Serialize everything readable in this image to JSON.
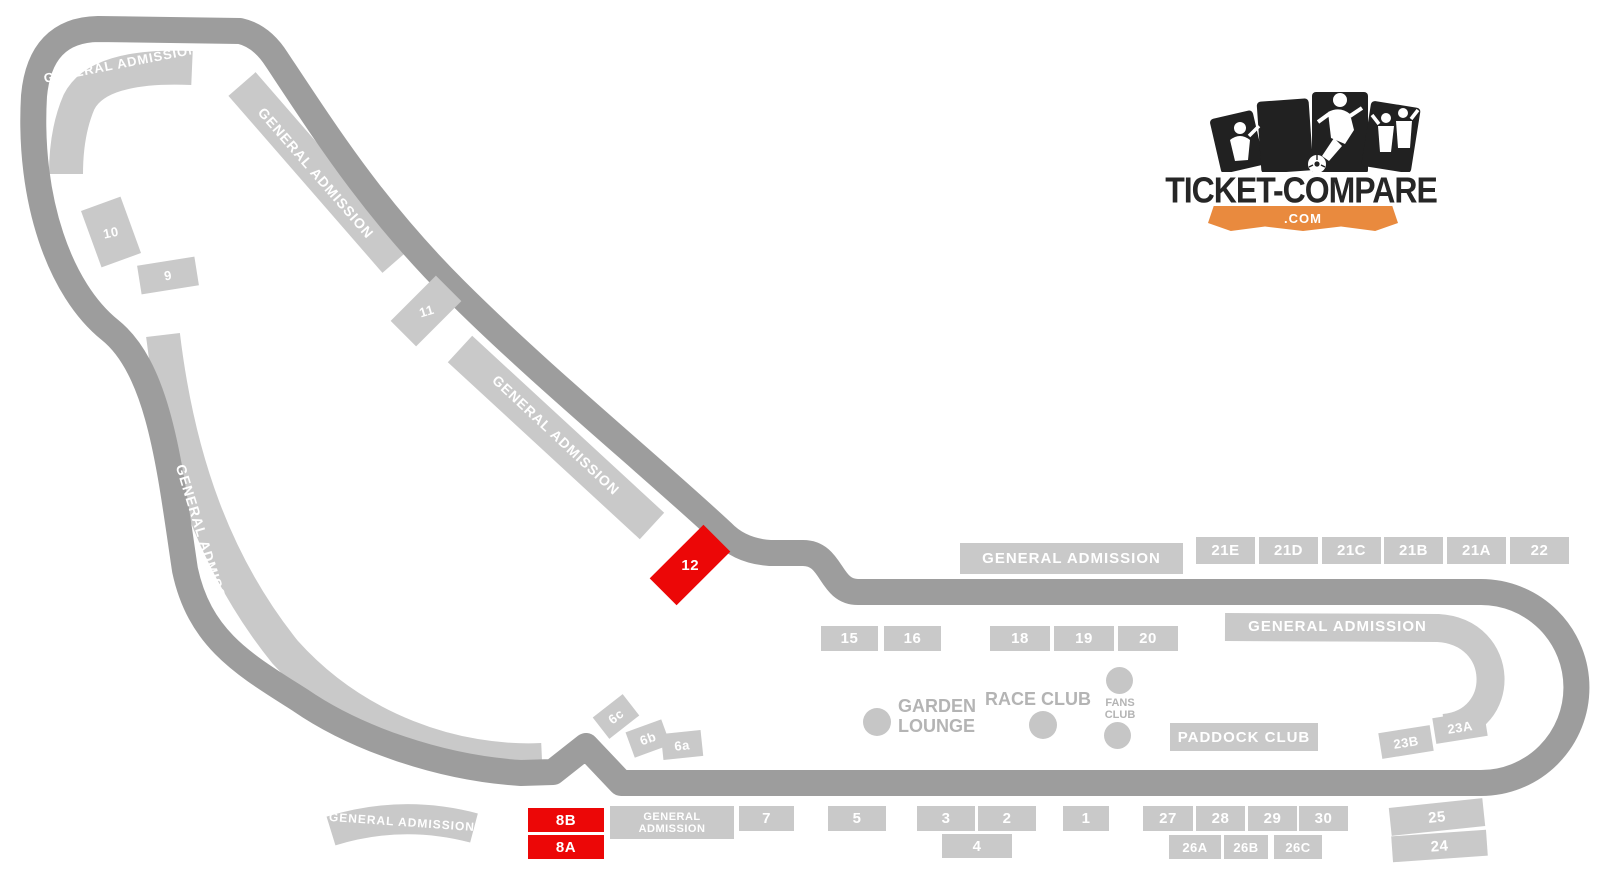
{
  "logo": {
    "title": "TICKET-COMPARE",
    "domain": ".COM"
  },
  "colors": {
    "track": "#9d9d9d",
    "stand_gray": "#c9c9c9",
    "stand_red": "#ec0707",
    "label_gray": "#b4b4b4",
    "logo_dark": "#212121",
    "logo_orange": "#e98a3e"
  },
  "general_admission": {
    "hairpin": "GENERAL ADMISSION",
    "curva_upper": "GENERAL ADMISSION",
    "curva_lower": "GENERAL ADMISSION",
    "left": "GENERAL ADMISSION",
    "bottom_arc": "GENERAL ADMISSION",
    "top_straight": "GENERAL ADMISSION",
    "parabolica": "GENERAL ADMISSION",
    "pit_straight": "GENERAL\nADMISSION"
  },
  "clubs": {
    "garden_lounge": "GARDEN\nLOUNGE",
    "race_club": "RACE CLUB",
    "fans_club": "FANS\nCLUB",
    "paddock_club": "PADDOCK CLUB"
  },
  "stands": {
    "s1": "1",
    "s2": "2",
    "s3": "3",
    "s4": "4",
    "s5": "5",
    "s7": "7",
    "s6a": "6a",
    "s6b": "6b",
    "s6c": "6c",
    "s8a": "8A",
    "s8b": "8B",
    "s9": "9",
    "s10": "10",
    "s11": "11",
    "s12": "12",
    "s15": "15",
    "s16": "16",
    "s18": "18",
    "s19": "19",
    "s20": "20",
    "s21a": "21A",
    "s21b": "21B",
    "s21c": "21C",
    "s21d": "21D",
    "s21e": "21E",
    "s22": "22",
    "s23a": "23A",
    "s23b": "23B",
    "s24": "24",
    "s25": "25",
    "s26a": "26A",
    "s26b": "26B",
    "s26c": "26C",
    "s27": "27",
    "s28": "28",
    "s29": "29",
    "s30": "30"
  }
}
